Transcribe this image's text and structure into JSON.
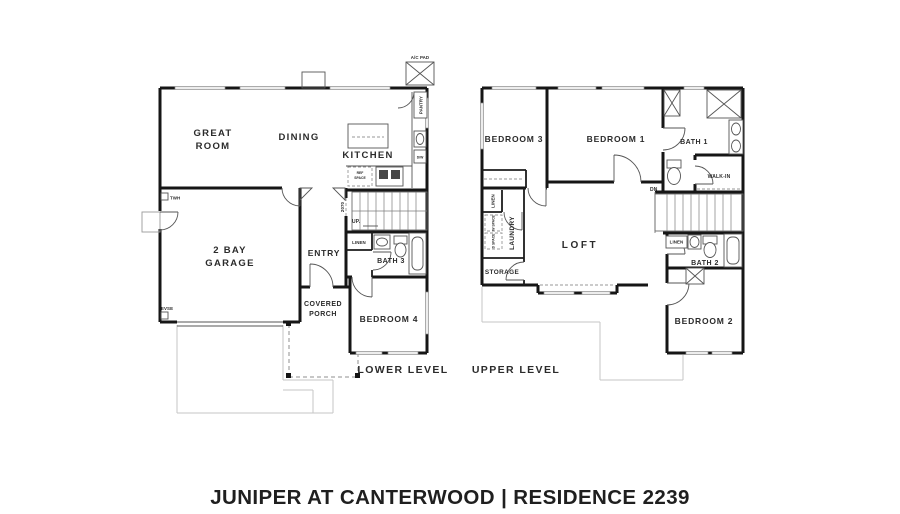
{
  "title": "JUNIPER AT CANTERWOOD | RESIDENCE 2239",
  "lower": {
    "caption": "LOWER LEVEL",
    "great_room_line1": "GREAT",
    "great_room_line2": "ROOM",
    "dining": "DINING",
    "kitchen": "KITCHEN",
    "garage_line1": "2 BAY",
    "garage_line2": "GARAGE",
    "entry": "ENTRY",
    "covered_porch_line1": "COVERED",
    "covered_porch_line2": "PORCH",
    "bedroom4": "BEDROOM 4",
    "bath3": "BATH 3",
    "linen": "LINEN",
    "up": "UP.",
    "door_tag": "2070",
    "ref_line1": "REF",
    "ref_line2": "SPACE",
    "dw": "D/W",
    "pantry": "PANTRY",
    "ac_pad": "A/C PAD",
    "twh": "TWH",
    "evse": "EVSE"
  },
  "upper": {
    "caption": "UPPER LEVEL",
    "bedroom1": "BEDROOM 1",
    "bedroom2": "BEDROOM 2",
    "bedroom3": "BEDROOM 3",
    "bath1": "BATH 1",
    "bath2": "BATH 2",
    "walk_in": "WALK-IN",
    "loft": "LOFT",
    "laundry": "LAUNDRY",
    "storage": "STORAGE",
    "linen_hall": "LINEN",
    "linen_bath2": "LINEN",
    "w_space": "W SPACE",
    "d_space": "D SPACE",
    "dn": "DN"
  }
}
